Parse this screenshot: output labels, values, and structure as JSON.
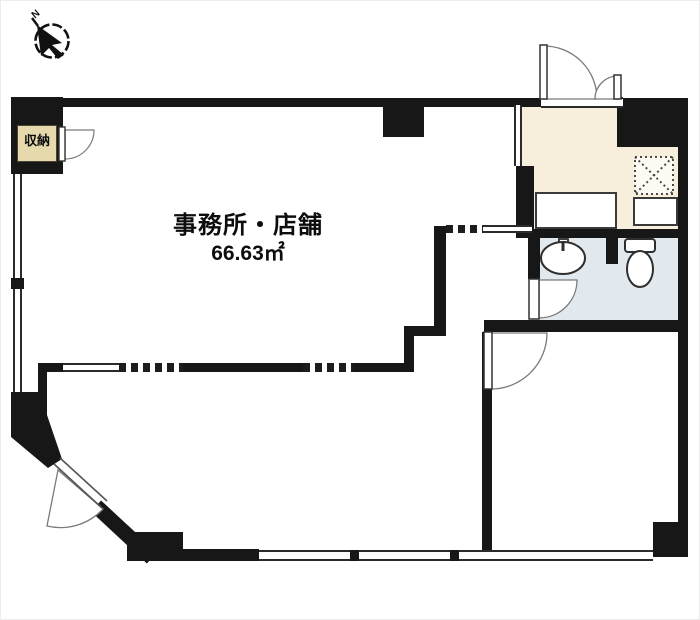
{
  "plan": {
    "room_label": "事務所・店舗",
    "room_area": "66.63㎡",
    "closet_label": "収納",
    "compass_mark": "N"
  },
  "icons": {
    "compass": "compass-north-arrow",
    "entrance_door": "double-swing-entry-door",
    "closet_door": "quarter-arc-swing-door",
    "washroom_door": "quarter-arc-swing-door",
    "lower_room_door": "quarter-arc-swing-door",
    "diagonal_door": "quarter-arc-swing-door",
    "washbasin": "oval-sink-with-faucet",
    "toilet": "toilet-with-tank",
    "shaft": "hatched-duct-shaft"
  },
  "colors": {
    "wall": "#171717",
    "entrance_floor": "#f7efdb",
    "bathroom_floor": "#e2e9ee",
    "closet_fill": "#e6d9ac",
    "paper": "#ffffff"
  }
}
